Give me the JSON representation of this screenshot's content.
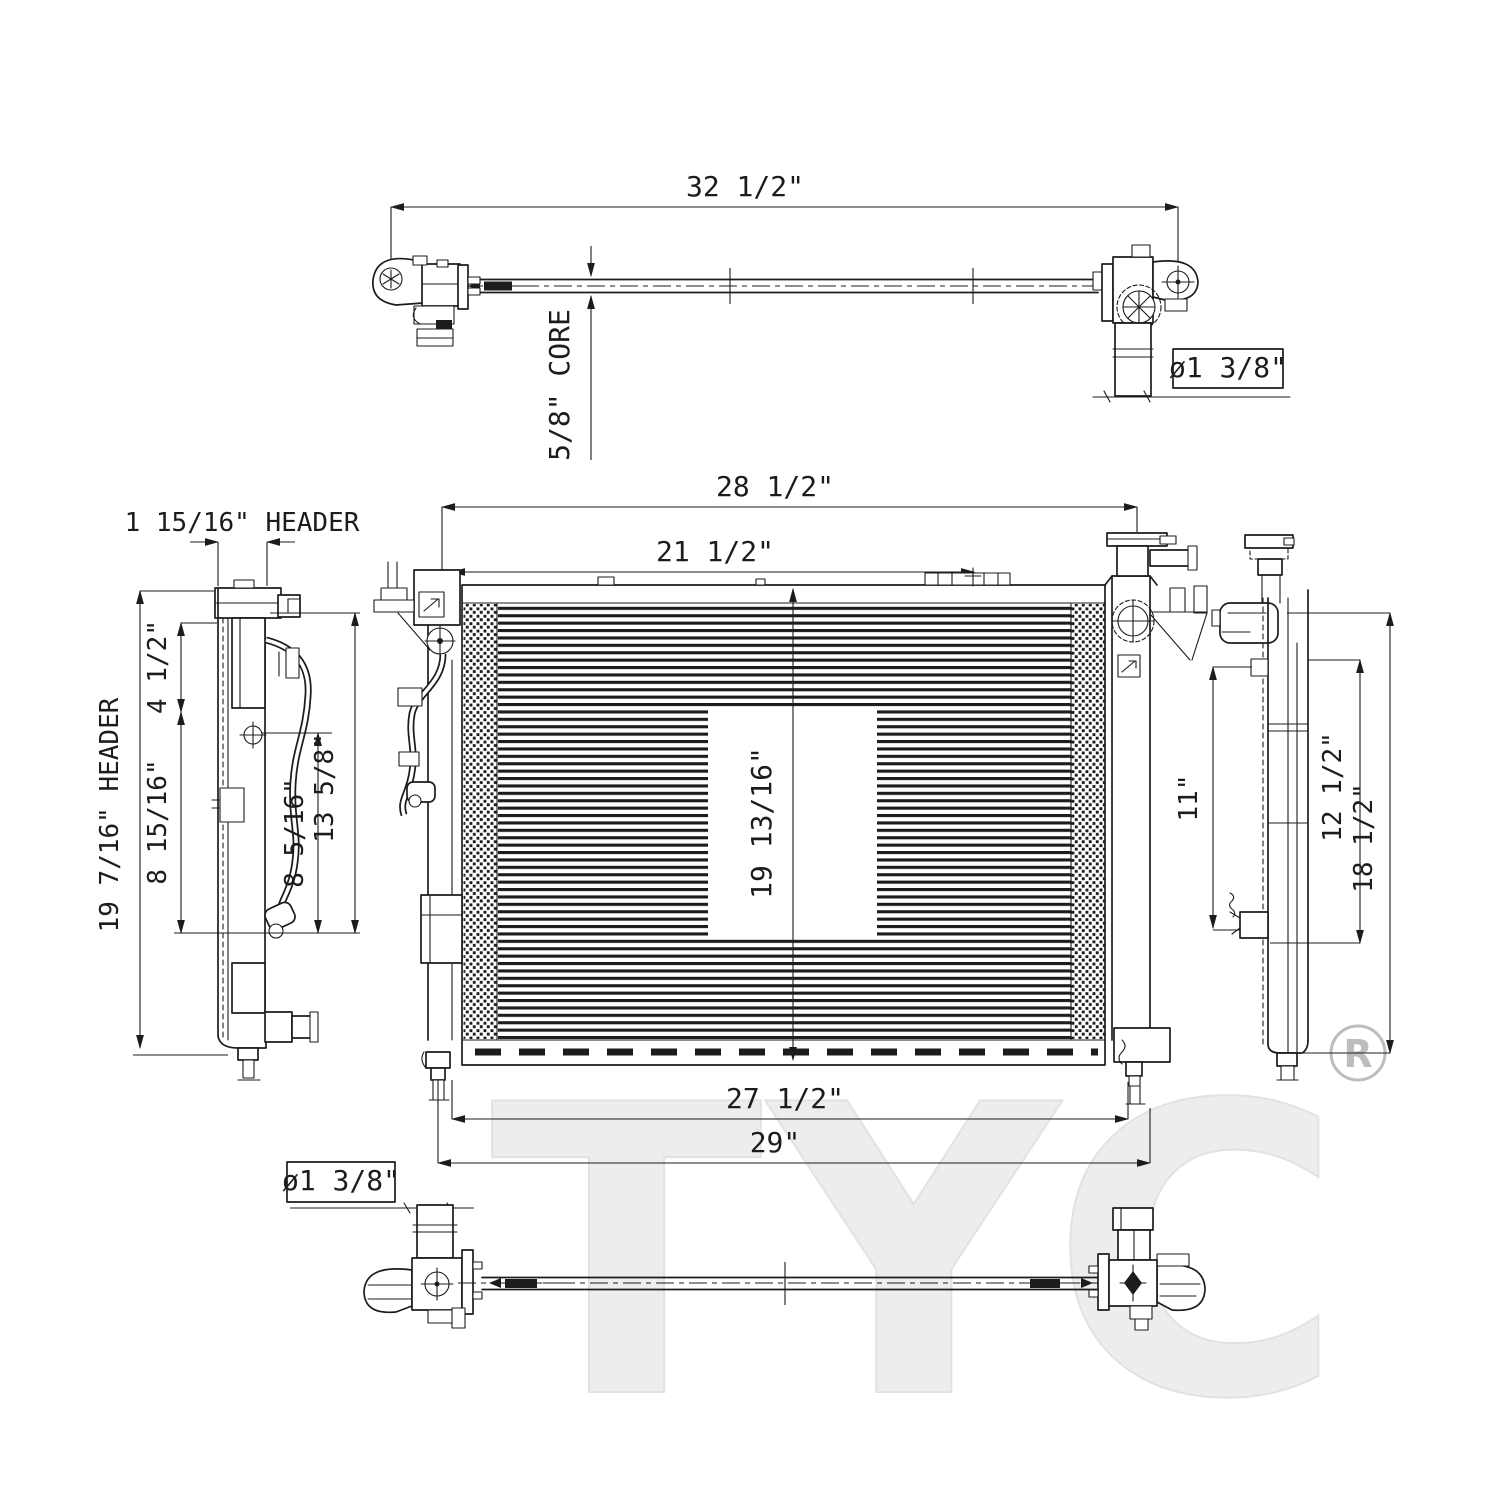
{
  "watermark": {
    "brand": "TYC",
    "registered": "R"
  },
  "top_view": {
    "dim_overall_width": "32 1/2\"",
    "dim_core_depth": "5/8\" CORE",
    "dim_pipe_diameter": "ø1 3/8\""
  },
  "front_view": {
    "dim_width_upper": "28 1/2\"",
    "dim_width_inner_top": "21 1/2\"",
    "dim_core_height": "19 13/16\"",
    "dim_width_inner_bottom": "27 1/2\"",
    "dim_width_overall_bottom": "29\""
  },
  "left_side_view": {
    "dim_header_depth": "1 15/16\" HEADER",
    "dim_header_height": "19 7/16\" HEADER",
    "dim_upper_port": "4 1/2\"",
    "dim_bracket_left": "8 15/16\"",
    "dim_bracket_right": "8 5/16\"",
    "dim_port_span": "13 5/8\""
  },
  "right_side_view": {
    "dim_inner": "11\"",
    "dim_mid": "12 1/2\"",
    "dim_outer": "18 1/2\""
  },
  "bottom_view": {
    "dim_pipe_diameter": "ø1 3/8\""
  }
}
